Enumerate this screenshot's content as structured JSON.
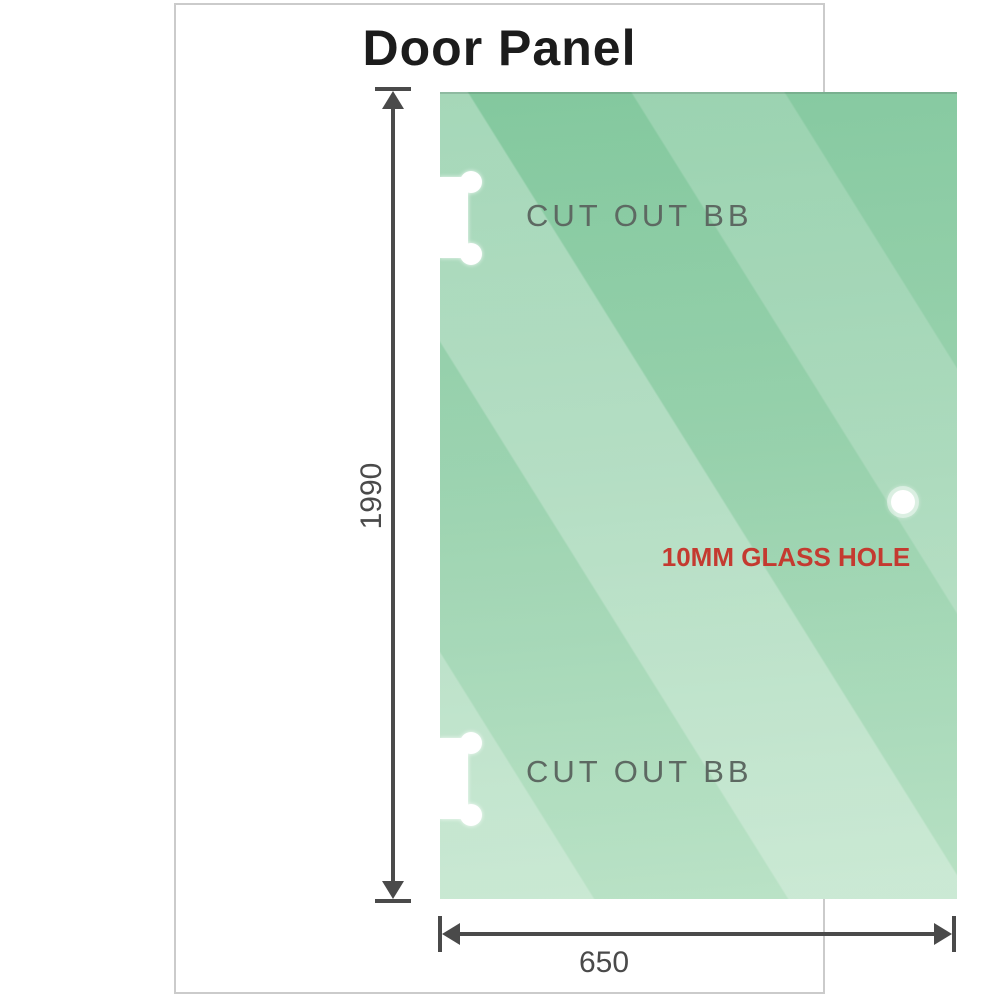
{
  "title": "Door Panel",
  "panel": {
    "glass_color_top": "#7ec69a",
    "glass_color_bottom": "#b5e0c2",
    "labels": {
      "cutout_top": "CUT OUT BB",
      "cutout_bottom": "CUT OUT BB",
      "glass_hole": "10MM GLASS HOLE"
    },
    "cutout_label_color": "#5d6962",
    "hole_label_color": "#c43a30"
  },
  "dimensions": {
    "height": "1990",
    "width": "650",
    "line_color": "#4a4a4a"
  }
}
